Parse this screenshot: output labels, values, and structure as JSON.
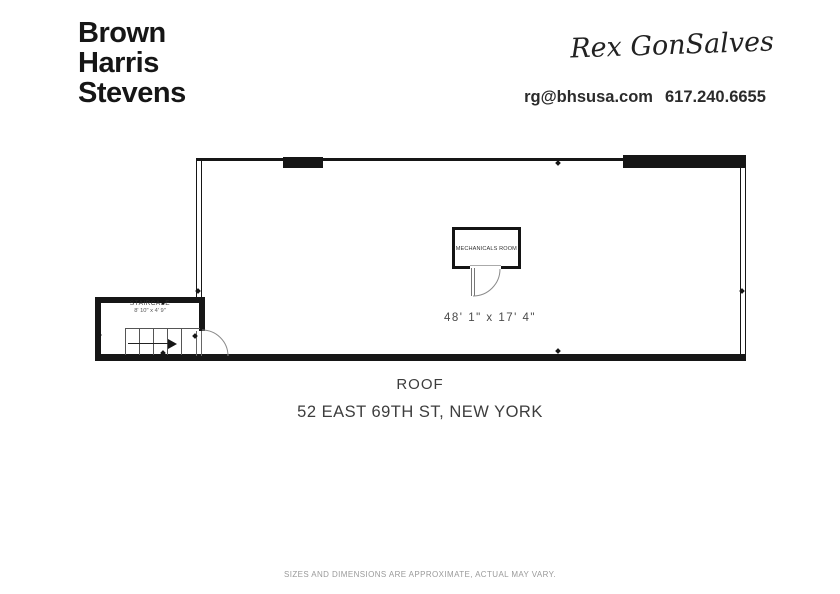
{
  "header": {
    "logo_lines": [
      "Brown",
      "Harris",
      "Stevens"
    ],
    "agent_signature": "Rex GonSalves",
    "contact": {
      "email": "rg@bhsusa.com",
      "phone": "617.240.6655"
    }
  },
  "plan": {
    "mechanicals_room_label": "MECHANICALS ROOM",
    "main_area_dimensions": "48' 1\" x 17' 4\"",
    "staircase_label": "STAIRCASE",
    "staircase_dimensions": "8' 10\" x 4' 9\""
  },
  "captions": {
    "floor_name": "ROOF",
    "address": "52 EAST 69TH ST, NEW YORK"
  },
  "footer": {
    "disclaimer": "SIZES AND DIMENSIONS ARE APPROXIMATE, ACTUAL MAY VARY."
  },
  "colors": {
    "wall": "#161616",
    "caption_text": "#3d3d3d",
    "dimension_text": "#4a4a4a",
    "muted_text": "#9a9a9a"
  }
}
